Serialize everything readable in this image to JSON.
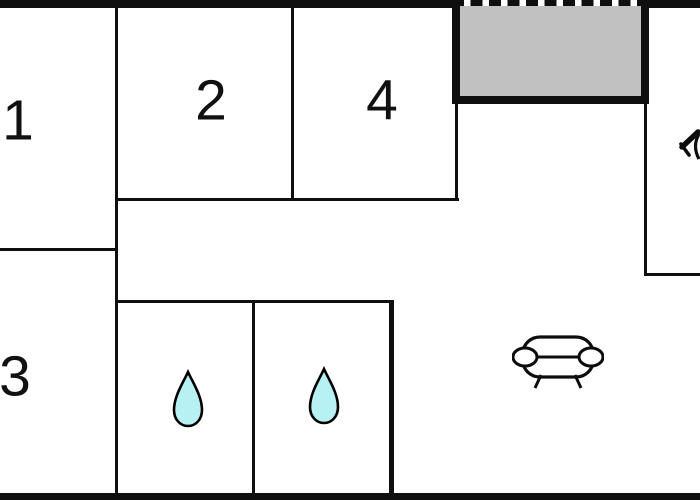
{
  "floorplan": {
    "rooms": [
      {
        "label": "1"
      },
      {
        "label": "2"
      },
      {
        "label": "3"
      },
      {
        "label": "4"
      }
    ],
    "areas": {
      "terrace": {
        "name": "covered-terrace"
      },
      "bathroom_left": {
        "name": "bathroom",
        "icon": "water-drop-icon"
      },
      "bathroom_right": {
        "name": "bathroom",
        "icon": "water-drop-icon"
      },
      "living_room": {
        "name": "living-room",
        "icon": "sofa-icon"
      },
      "kitchen": {
        "name": "kitchen",
        "icon": "cutlery-icon"
      }
    },
    "colors": {
      "wall": "#0f0f0f",
      "terrace_fill": "#c1c1c1",
      "drop_fill": "#b7f1f3",
      "background": "#ffffff"
    }
  }
}
